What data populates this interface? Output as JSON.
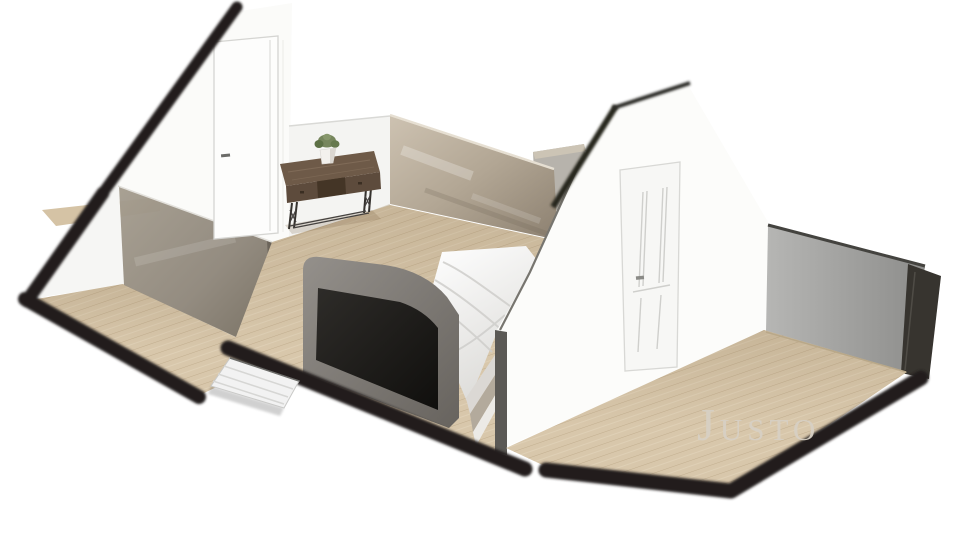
{
  "meta": {
    "description": "Isometric 3D cutaway (dollhouse) rendering of an attic bedroom floor plan",
    "view": "3d-floor-plan-render"
  },
  "watermark": {
    "initial": "J",
    "rest": "USTO",
    "full_text": "JUSTO",
    "color": "#d7d0c4"
  },
  "palette": {
    "background": "#ffffff",
    "wall_white": "#fbfbf9",
    "roof_cut_edge": "#201e1c",
    "floor_wood": "#d8c7ab",
    "floor_plank_line": "#c2ae8f",
    "glass_partition_tinted": "#8f877b",
    "glass_partition_beige": "#b2a694",
    "knee_wall_gray": "#a1a19f",
    "bed_frame_gray": "#7d7974",
    "tv_screen": "#171512",
    "desk_wood": "#6e5a48",
    "plant_green": "#76865d",
    "stairs_white": "#f2f2f2"
  },
  "objects": {
    "left_gable": "gable end wall with plain door",
    "middle_gable": "gable wall with paneled door",
    "left_room": "small attic room with tinted glass partition",
    "bedroom": "attic bedroom",
    "right_room": "open attic room with gray knee wall",
    "tv_bed": "bed with TV footboard",
    "console_desk": "dark wood console desk",
    "potted_plant": "plant in white pot",
    "staircase": "white stair landing",
    "wood_floor": "light oak plank floor"
  }
}
